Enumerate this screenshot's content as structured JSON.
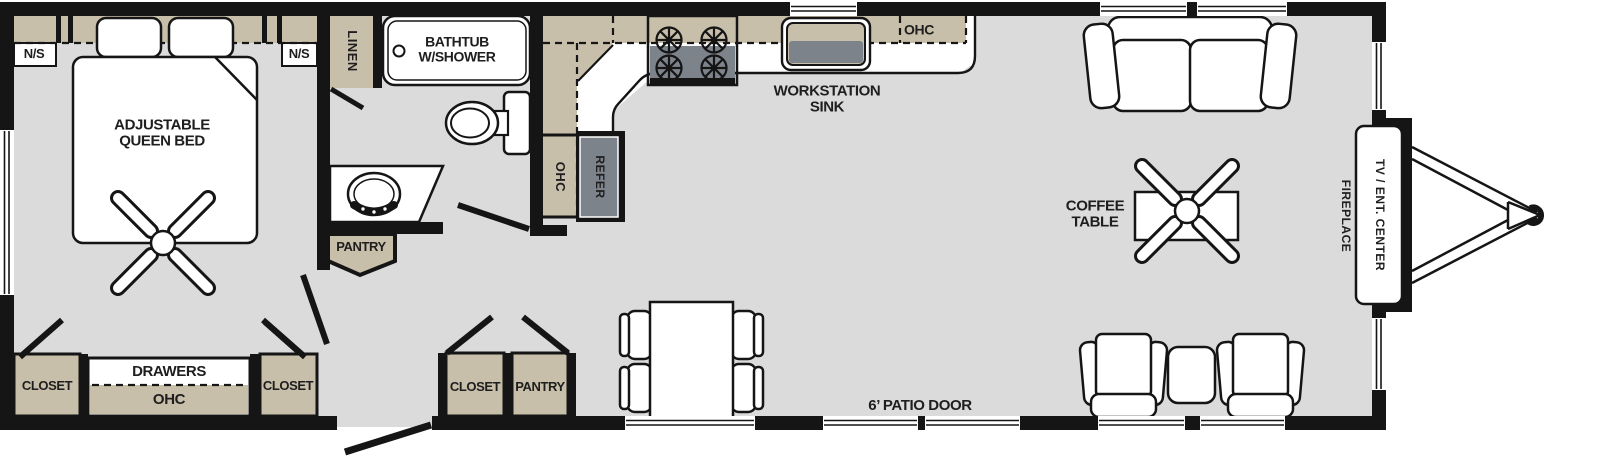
{
  "title": "travel-trailer floor plan",
  "colors": {
    "wall": "#151515",
    "floor": "#dbdbdb",
    "cabinet_tan": "#c8bfaa",
    "appliance_gray": "#7d838b",
    "fixture_white": "#ffffff",
    "label_text": "#1e1e1e"
  },
  "rooms": {
    "bedroom": {
      "nightstand_left": "N/S",
      "nightstand_right": "N/S",
      "bed": "ADJUSTABLE\nQUEEN BED",
      "closet_left": "CLOSET",
      "drawers": "DRAWERS",
      "ohc": "OHC",
      "closet_right": "CLOSET"
    },
    "bathroom": {
      "linen": "LINEN",
      "bathtub": "BATHTUB\nW/SHOWER",
      "pantry": "PANTRY"
    },
    "kitchen": {
      "ohc_side": "OHC",
      "refrigerator": "REFER",
      "sink": "WORKSTATION\nSINK",
      "ohc_top": "OHC"
    },
    "hallway": {
      "closet": "CLOSET",
      "pantry": "PANTRY"
    },
    "living_area": {
      "coffee_table": "COFFEE\nTABLE",
      "patio_door": "6’ PATIO DOOR",
      "fireplace": "FIREPLACE",
      "tv_center": "TV / ENT. CENTER"
    }
  }
}
